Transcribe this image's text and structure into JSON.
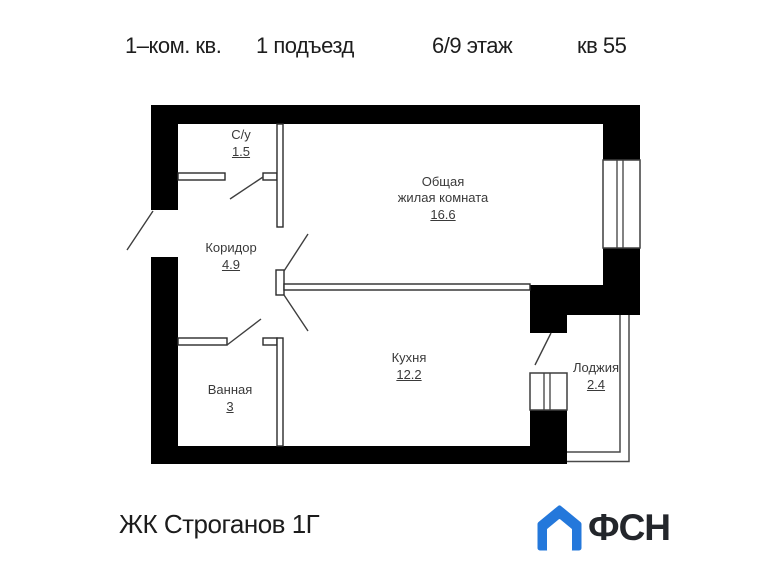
{
  "header": {
    "apartment_type": "1–ком. кв.",
    "entrance": "1 подъезд",
    "floor": "6/9 этаж",
    "unit": "кв 55"
  },
  "rooms": [
    {
      "name": "С/у",
      "area": "1.5"
    },
    {
      "name": "Общая",
      "name2": "жилая комната",
      "area": "16.6"
    },
    {
      "name": "Коридор",
      "area": "4.9"
    },
    {
      "name": "Кухня",
      "area": "12.2"
    },
    {
      "name": "Ванная",
      "area": "3"
    },
    {
      "name": "Лоджия",
      "area": "2.4"
    }
  ],
  "footer": {
    "complex_name": "ЖК Строганов 1Г",
    "logo_text": "ФСН"
  },
  "icons": {
    "logo_house": "house-icon"
  },
  "colors": {
    "wall": "#000000",
    "thin_line": "#3f3f3f",
    "label_text": "#3a3a3a",
    "logo_blue": "#2478db",
    "logo_dark": "#23262b"
  }
}
